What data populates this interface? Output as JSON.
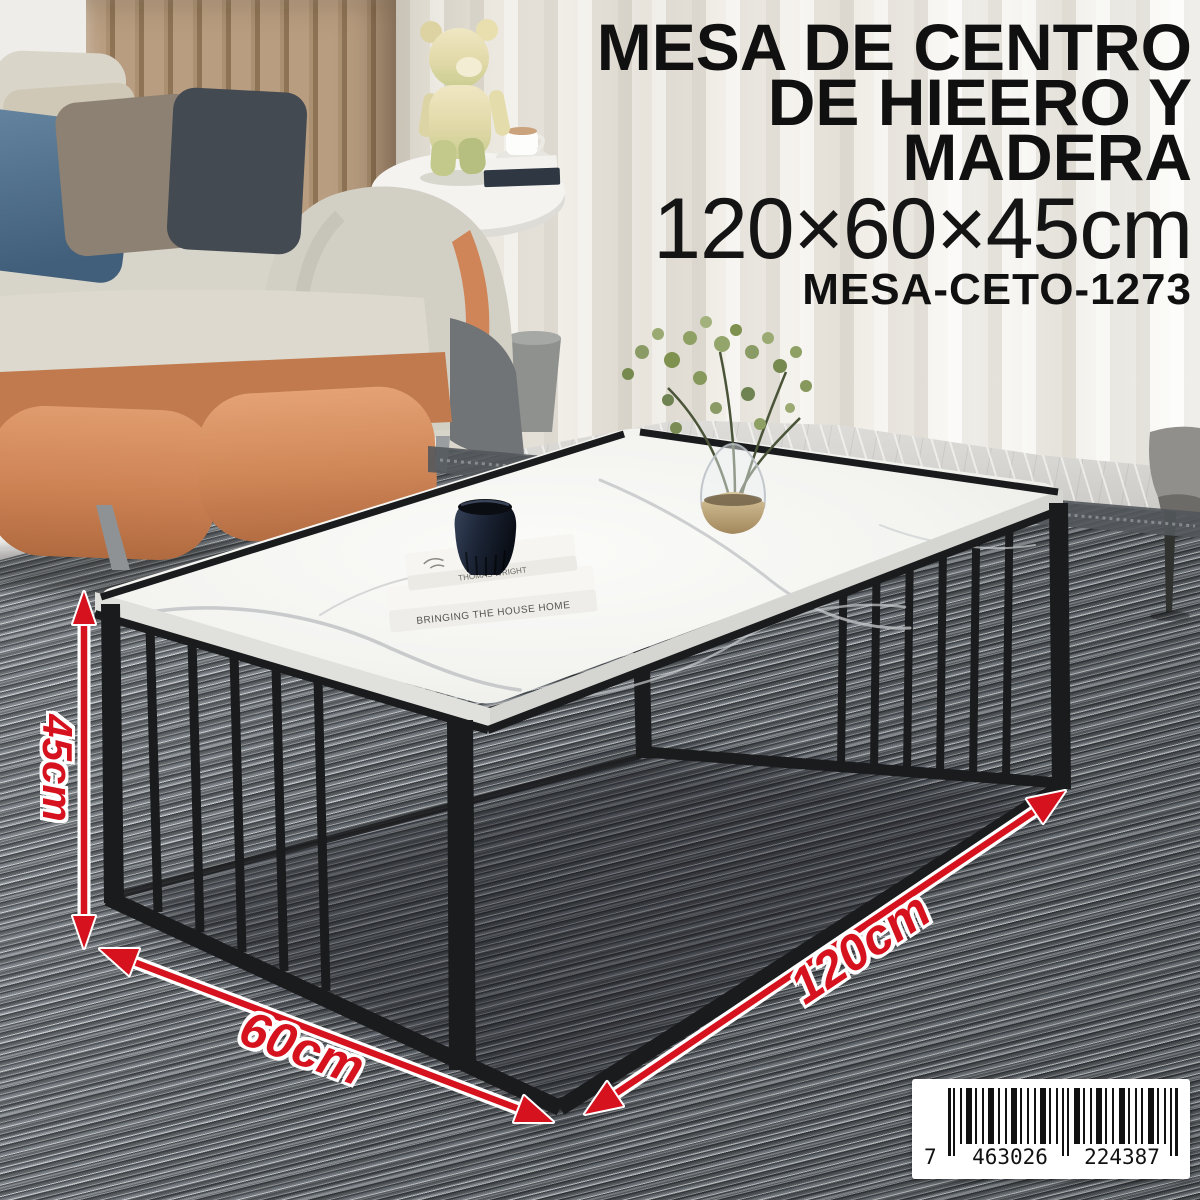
{
  "product": {
    "title_line1": "MESA DE CENTRO",
    "title_line2": "DE HIEERO Y MADERA",
    "size_text": "120×60×45cm",
    "sku": "MESA-CETO-1273"
  },
  "dimensions": {
    "height_label": "45cm",
    "depth_label": "60cm",
    "width_label": "120cm"
  },
  "barcode": {
    "lead_digit": "7",
    "group1": "463026",
    "group2": "224387"
  },
  "decor_books": {
    "spine_top": "THOMAS WRIGHT",
    "spine_bottom": "BRINGING THE HOUSE HOME"
  },
  "colors": {
    "accent_red": "#d5121e",
    "frame_black": "#1a1b1d",
    "marble_white": "#f5f5f3",
    "leather_orange": "#cf8557",
    "rug_grey": "#8b9094",
    "wood_tan": "#b1977a",
    "curtain_cream": "#ece9e2"
  }
}
